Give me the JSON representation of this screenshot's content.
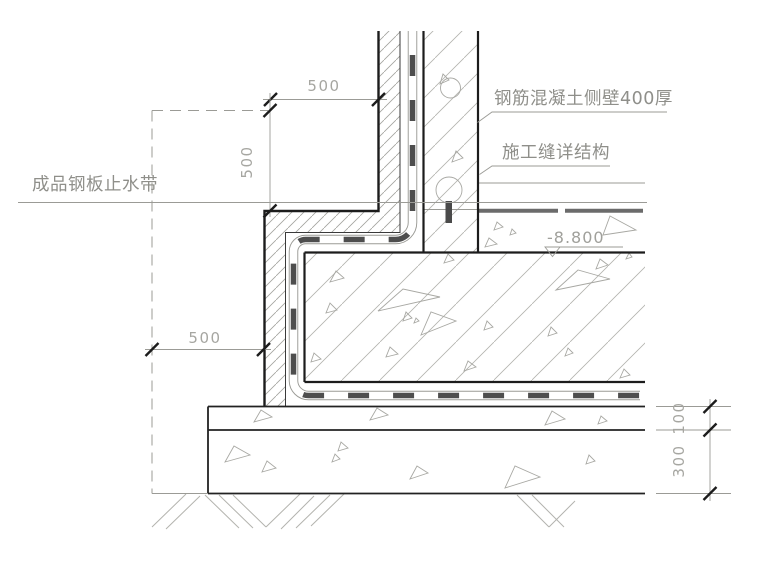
{
  "drawing": {
    "title": "basement-wall-slab-waterproofing-detail",
    "annotations": {
      "wall_label": "钢筋混凝土侧壁400厚",
      "joint_label": "施工缝详结构",
      "waterstop_label": "成品钢板止水带"
    },
    "elevation": {
      "value": "-8.800"
    },
    "dimensions": {
      "top_width": "500",
      "side_height": "500",
      "bottom_offset": "500",
      "cushion_upper": "100",
      "cushion_lower": "300"
    },
    "colors": {
      "structure_line": "#1c1c1c",
      "membrane_dash": "#4e4e4e",
      "steel_waterstop": "#4a4a4a",
      "annotation_text": "#8f8f8a",
      "dimension_text": "#a6a6a1"
    }
  }
}
